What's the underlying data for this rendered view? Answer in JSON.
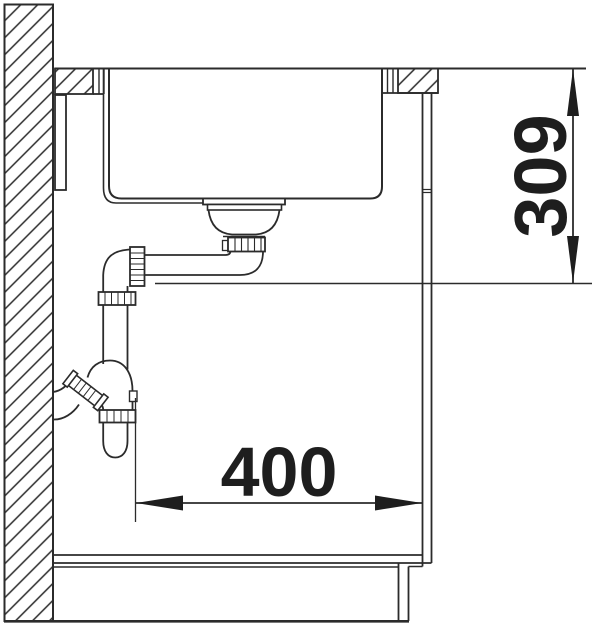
{
  "diagram": {
    "type": "technical-drawing",
    "subject": "Sink installation cross-section with waste strainer, space-saver siphon and base cabinet",
    "background": "#ffffff",
    "line_color": "#2b2b2b",
    "dimensions": [
      {
        "id": "installation-height",
        "value": "309",
        "orientation": "vertical",
        "description": "distance from worktop surface down to drain pipe level"
      },
      {
        "id": "installation-depth",
        "value": "400",
        "orientation": "horizontal",
        "description": "distance from siphon wall outlet line to cabinet side panel"
      }
    ],
    "components": [
      "hatched-wall",
      "worktop",
      "sink-bowl",
      "strainer-waste",
      "drain-elbow",
      "siphon-trap",
      "wall-outlet",
      "cabinet-side-panel",
      "cabinet-bottom-shelf",
      "plinth",
      "floor-line"
    ]
  }
}
